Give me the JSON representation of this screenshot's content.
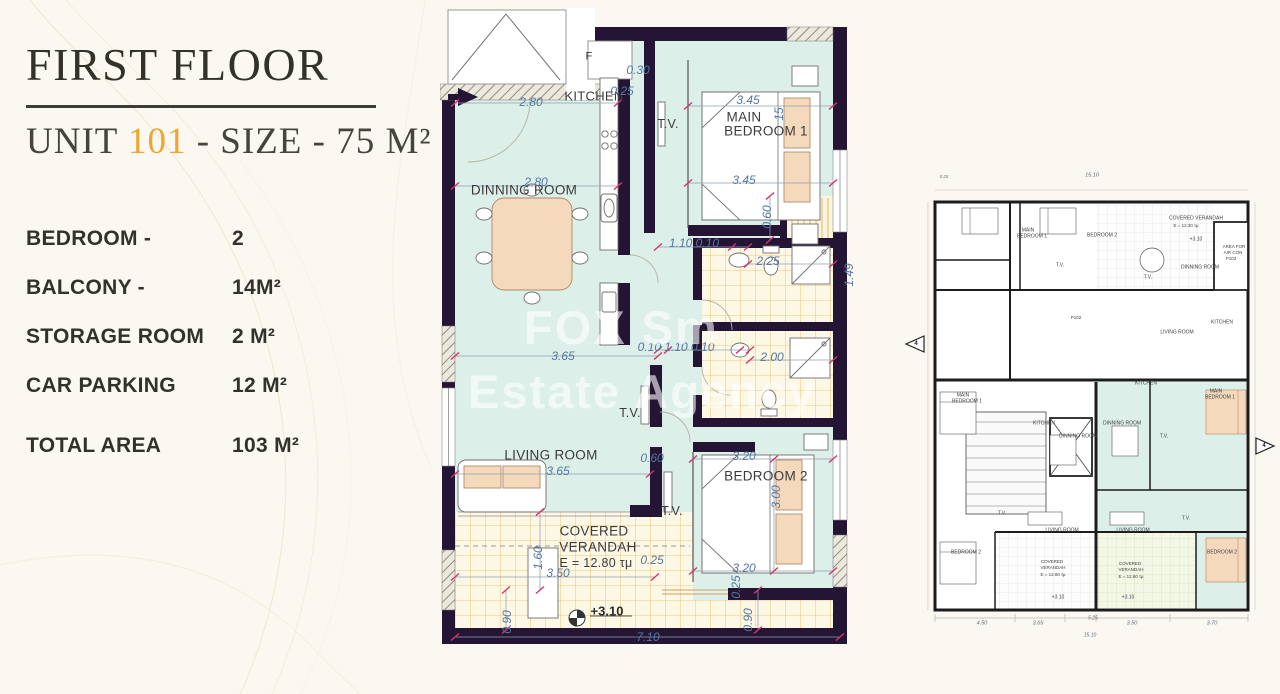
{
  "colors": {
    "paper": "#fbf8f1",
    "gold": "#efa62e",
    "wall": "#241535",
    "mint": "#dcefe9",
    "dimblue": "#53779f",
    "tick": "#d6336c",
    "peach": "#f5d9bd",
    "wmcol": "rgba(255,255,255,0.6)"
  },
  "panel": {
    "title": "FIRST FLOOR",
    "unit_prefix": "UNIT ",
    "unit_number": "101",
    "unit_suffix": " - SIZE - 75 M²",
    "specs": [
      {
        "label": "BEDROOM -",
        "value": "2"
      },
      {
        "label": "BALCONY -",
        "value": "14M²"
      },
      {
        "label": "STORAGE ROOM",
        "value": "2 M²"
      },
      {
        "label": "CAR PARKING",
        "value": "12 M²"
      },
      {
        "label": "TOTAL AREA",
        "value": "103 M²",
        "gap": true
      }
    ]
  },
  "watermark": {
    "line1": "FOX Sm",
    "line2": "Estate Agency"
  },
  "main_plan": {
    "room_labels": [
      {
        "t": "KITCHEN",
        "x": 594,
        "y": 96,
        "s": 13
      },
      {
        "t": "DINNING ROOM",
        "x": 524,
        "y": 190,
        "s": 13.5
      },
      {
        "t": "MAIN",
        "x": 744,
        "y": 117,
        "s": 13.5
      },
      {
        "t": "BEDROOM 1",
        "x": 766,
        "y": 131,
        "s": 13.5
      },
      {
        "t": "T.V.",
        "x": 668,
        "y": 124,
        "s": 12.5
      },
      {
        "t": "T.V.",
        "x": 630,
        "y": 413,
        "s": 12.5
      },
      {
        "t": "T.V.",
        "x": 672,
        "y": 511,
        "s": 12.5
      },
      {
        "t": "LIVING ROOM",
        "x": 551,
        "y": 455,
        "s": 13.5
      },
      {
        "t": "BEDROOM 2",
        "x": 766,
        "y": 476,
        "s": 13.5
      },
      {
        "t": "COVERED",
        "x": 594,
        "y": 531,
        "s": 13.5
      },
      {
        "t": "VERANDAH",
        "x": 598,
        "y": 547,
        "s": 13.5
      },
      {
        "t": "E = 12.80 τμ",
        "x": 596,
        "y": 563,
        "s": 12.5
      },
      {
        "t": "F",
        "x": 589,
        "y": 57,
        "s": 11
      },
      {
        "t": "+3.10",
        "x": 607,
        "y": 611,
        "s": 13,
        "k": "lvl"
      }
    ],
    "dim_labels": [
      {
        "t": "2.80",
        "x": 531,
        "y": 102
      },
      {
        "t": "0.25",
        "x": 622,
        "y": 91
      },
      {
        "t": "0.30",
        "x": 638,
        "y": 70
      },
      {
        "t": "3.45",
        "x": 748,
        "y": 100
      },
      {
        "t": "3.45",
        "x": 744,
        "y": 180
      },
      {
        "t": "2.80",
        "x": 536,
        "y": 182
      },
      {
        "t": "15",
        "x": 779,
        "y": 114,
        "r": -90
      },
      {
        "t": "0.60",
        "x": 767,
        "y": 217,
        "r": -90
      },
      {
        "t": "1.10 0.10",
        "x": 694,
        "y": 243
      },
      {
        "t": "2.25",
        "x": 768,
        "y": 261
      },
      {
        "t": "1.49",
        "x": 849,
        "y": 275,
        "r": -90
      },
      {
        "t": "3.65",
        "x": 563,
        "y": 356
      },
      {
        "t": "0.10 1.10 0.10",
        "x": 676,
        "y": 347
      },
      {
        "t": "2.00",
        "x": 772,
        "y": 357
      },
      {
        "t": "3.65",
        "x": 558,
        "y": 471
      },
      {
        "t": "0.60",
        "x": 652,
        "y": 458
      },
      {
        "t": "3.20",
        "x": 744,
        "y": 456
      },
      {
        "t": "3.00",
        "x": 776,
        "y": 497,
        "r": -90
      },
      {
        "t": "3.20",
        "x": 744,
        "y": 568
      },
      {
        "t": "0.25",
        "x": 736,
        "y": 587,
        "r": -90
      },
      {
        "t": "1.60",
        "x": 538,
        "y": 558,
        "r": -90
      },
      {
        "t": "3.50",
        "x": 558,
        "y": 573
      },
      {
        "t": "0.25",
        "x": 652,
        "y": 560
      },
      {
        "t": "0.90",
        "x": 507,
        "y": 622,
        "r": -90
      },
      {
        "t": "0.90",
        "x": 748,
        "y": 620,
        "r": -90
      },
      {
        "t": "7.10",
        "x": 648,
        "y": 637
      }
    ]
  },
  "overview": {
    "labels": [
      {
        "t": "COVERED VERANDAH",
        "x": 1196,
        "y": 219,
        "s": 5
      },
      {
        "t": "E = 12.30 τμ",
        "x": 1186,
        "y": 226,
        "s": 4.5
      },
      {
        "t": "+3.10",
        "x": 1196,
        "y": 240,
        "s": 5
      },
      {
        "t": "AREA FOR",
        "x": 1234,
        "y": 247,
        "s": 4.5
      },
      {
        "t": "AIR CON",
        "x": 1233,
        "y": 253,
        "s": 4.5
      },
      {
        "t": "P103",
        "x": 1231,
        "y": 259,
        "s": 4.5
      },
      {
        "t": "DINNING ROOM",
        "x": 1200,
        "y": 268,
        "s": 5
      },
      {
        "t": "KITCHEN",
        "x": 1222,
        "y": 323,
        "s": 5
      },
      {
        "t": "LIVING ROOM",
        "x": 1177,
        "y": 333,
        "s": 5
      },
      {
        "t": "MAIN",
        "x": 1028,
        "y": 231,
        "s": 5
      },
      {
        "t": "BEDROOM 1",
        "x": 1032,
        "y": 237,
        "s": 5
      },
      {
        "t": "BEDROOM 2",
        "x": 1102,
        "y": 236,
        "s": 5
      },
      {
        "t": "T.V.",
        "x": 1060,
        "y": 266,
        "s": 5
      },
      {
        "t": "T.V.",
        "x": 1148,
        "y": 278,
        "s": 5
      },
      {
        "t": "P102",
        "x": 1076,
        "y": 318,
        "s": 4.5
      },
      {
        "t": "MAIN",
        "x": 963,
        "y": 396,
        "s": 5
      },
      {
        "t": "BEDROOM 1",
        "x": 967,
        "y": 402,
        "s": 5
      },
      {
        "t": "KITCHEN",
        "x": 1044,
        "y": 424,
        "s": 5
      },
      {
        "t": "DINNING ROOM",
        "x": 1078,
        "y": 437,
        "s": 5
      },
      {
        "t": "KITCHEN",
        "x": 1146,
        "y": 384,
        "s": 5
      },
      {
        "t": "DINNING ROOM",
        "x": 1122,
        "y": 424,
        "s": 5
      },
      {
        "t": "MAIN",
        "x": 1216,
        "y": 392,
        "s": 5
      },
      {
        "t": "BEDROOM 1",
        "x": 1220,
        "y": 398,
        "s": 5
      },
      {
        "t": "T.V.",
        "x": 1002,
        "y": 514,
        "s": 5
      },
      {
        "t": "T.V.",
        "x": 1186,
        "y": 519,
        "s": 5
      },
      {
        "t": "T.V.",
        "x": 1164,
        "y": 437,
        "s": 5
      },
      {
        "t": "LIVING ROOM",
        "x": 1062,
        "y": 531,
        "s": 5
      },
      {
        "t": "LIVING ROOM",
        "x": 1133,
        "y": 531,
        "s": 5
      },
      {
        "t": "BEDROOM 2",
        "x": 966,
        "y": 553,
        "s": 5
      },
      {
        "t": "BEDROOM 2",
        "x": 1222,
        "y": 553,
        "s": 5
      },
      {
        "t": "COVERED",
        "x": 1052,
        "y": 562,
        "s": 4.5
      },
      {
        "t": "VERANDAH",
        "x": 1053,
        "y": 568,
        "s": 4.5
      },
      {
        "t": "E = 13.80 τμ",
        "x": 1053,
        "y": 575,
        "s": 4.5
      },
      {
        "t": "COVERED",
        "x": 1130,
        "y": 564,
        "s": 4.5
      },
      {
        "t": "VERANDAH",
        "x": 1131,
        "y": 570,
        "s": 4.5
      },
      {
        "t": "E = 12.80 τμ",
        "x": 1131,
        "y": 577,
        "s": 4.5
      },
      {
        "t": "+3.10",
        "x": 1058,
        "y": 598,
        "s": 5
      },
      {
        "t": "+3.10",
        "x": 1128,
        "y": 598,
        "s": 5
      },
      {
        "t": "4",
        "x": 916,
        "y": 344,
        "s": 6,
        "k": "ovm"
      },
      {
        "t": "4",
        "x": 1264,
        "y": 446,
        "s": 6,
        "k": "ovm"
      }
    ],
    "dim_labels": [
      {
        "t": "15.10",
        "x": 1092,
        "y": 176,
        "s": 5.5
      },
      {
        "t": "0.25",
        "x": 944,
        "y": 177,
        "s": 4.5
      },
      {
        "t": "4.50",
        "x": 982,
        "y": 624,
        "s": 5.5
      },
      {
        "t": "3.65",
        "x": 1038,
        "y": 624,
        "s": 5.5
      },
      {
        "t": "5.25",
        "x": 1093,
        "y": 619,
        "s": 5
      },
      {
        "t": "3.50",
        "x": 1132,
        "y": 624,
        "s": 5.5
      },
      {
        "t": "3.70",
        "x": 1212,
        "y": 624,
        "s": 5.5
      },
      {
        "t": "15.10",
        "x": 1090,
        "y": 636,
        "s": 5
      }
    ]
  }
}
